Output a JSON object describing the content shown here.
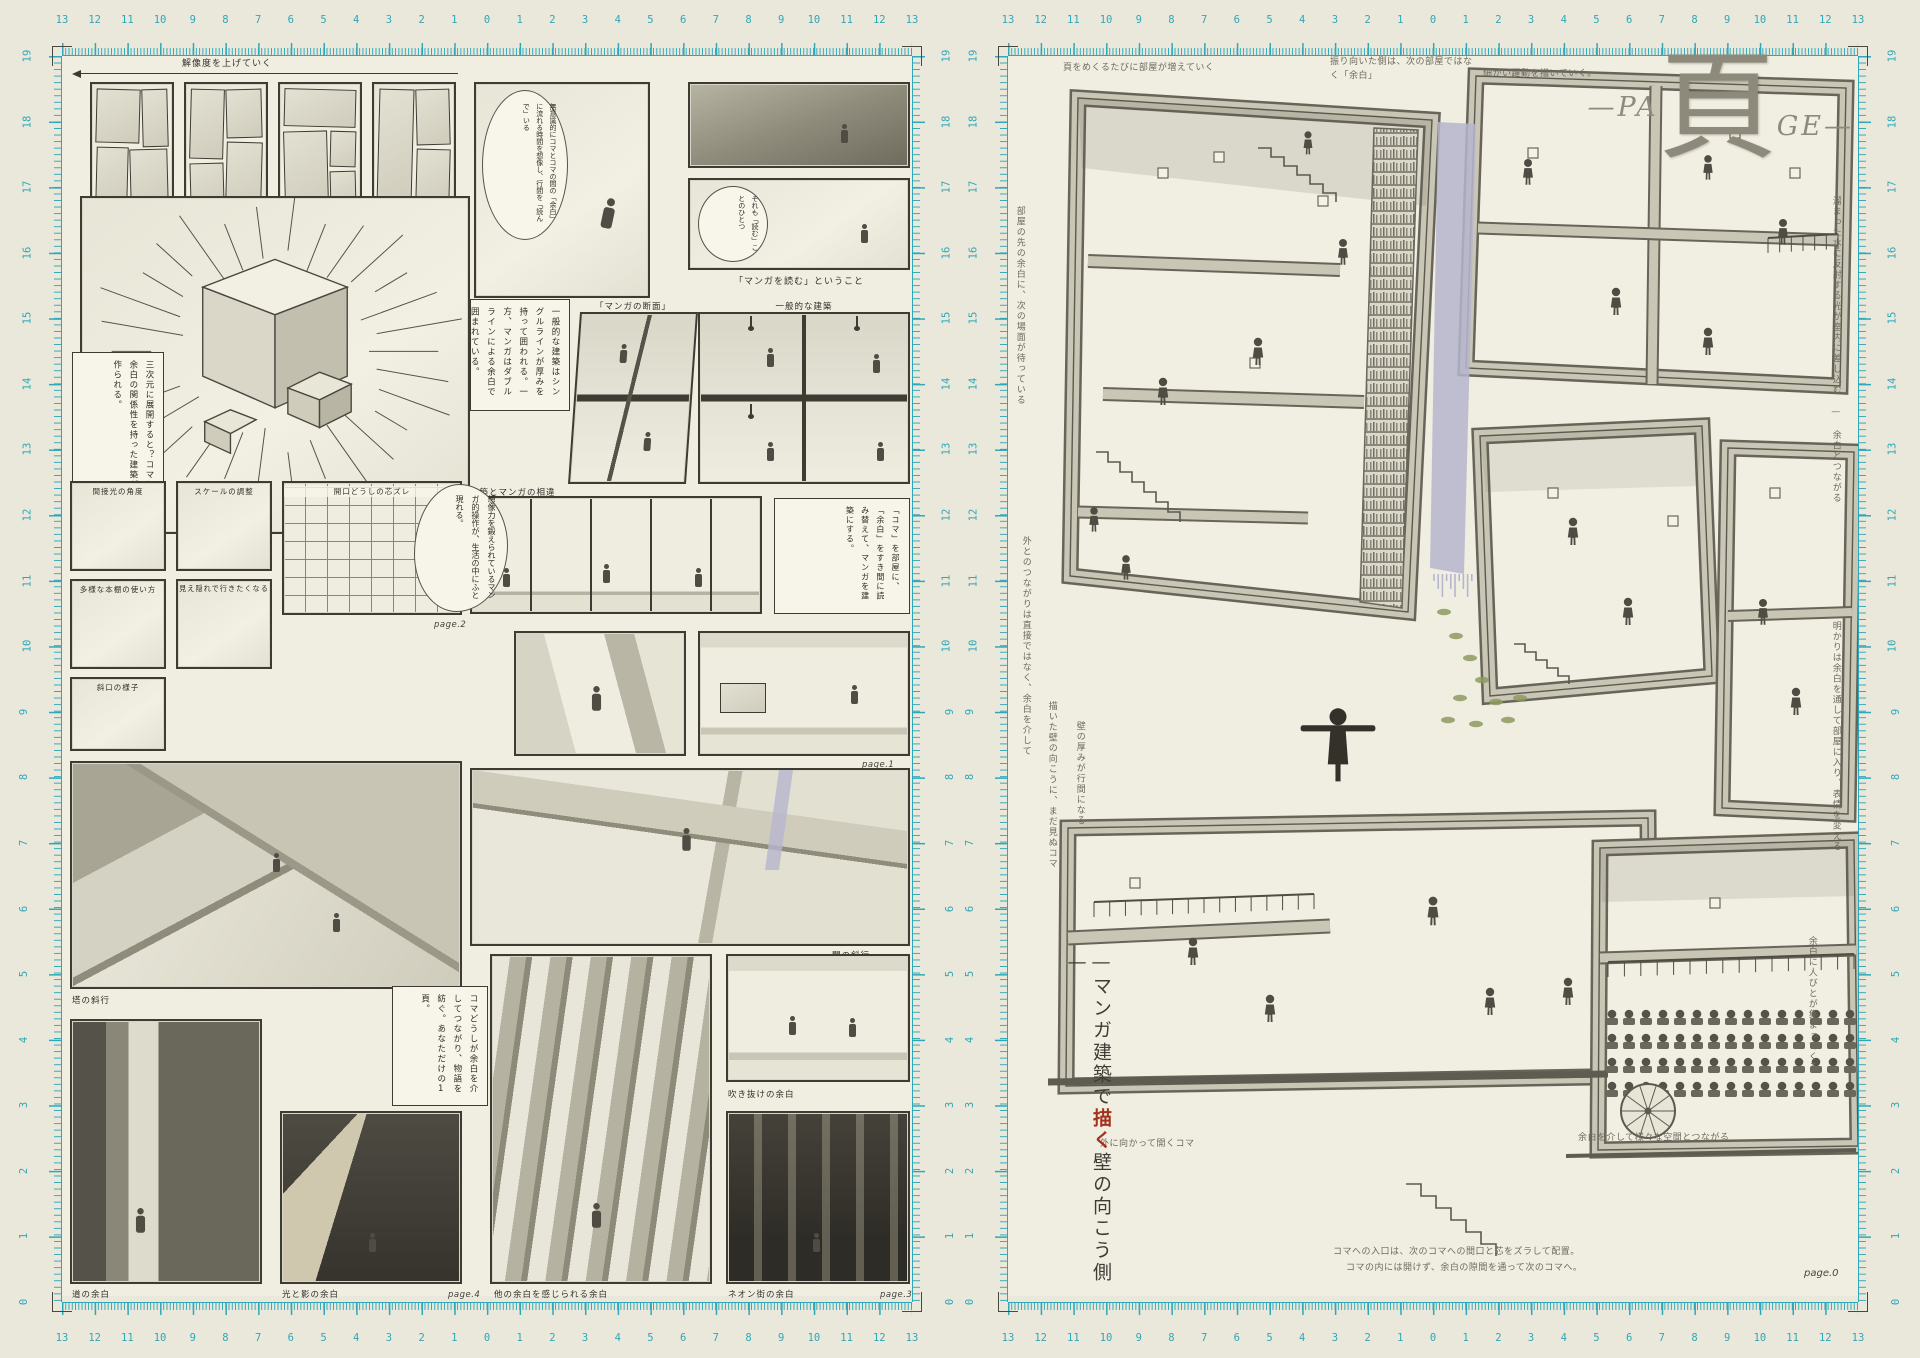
{
  "colors": {
    "ruler": "#2fa7ba",
    "accent_red": "#a3321f",
    "lavender": "#b6b5ce",
    "moss": "#8e9a60",
    "concrete": "#c9c6b6",
    "title_gray": "#8d8a7b",
    "paper": "#eae8da"
  },
  "rulers": {
    "h_numbers": [
      13,
      12,
      11,
      10,
      9,
      8,
      7,
      6,
      5,
      4,
      3,
      2,
      1,
      0,
      1,
      2,
      3,
      4,
      5,
      6,
      7,
      8,
      9,
      10,
      11,
      12,
      13
    ],
    "v_numbers": [
      19,
      18,
      17,
      16,
      15,
      14,
      13,
      12,
      11,
      10,
      9,
      8,
      7,
      6,
      5,
      4,
      3,
      2,
      1,
      0
    ]
  },
  "left_page": {
    "resolution_caption": "解像度を上げていく",
    "reader_label": "読み手側",
    "reading_bubble": "無意識的にコマとコマの間の「余白」に流れる時間を想像し、行間を「読んで」いる",
    "sore_bubble": "それも「読む」ことのひとつ",
    "reading_caption": "「マンガを読む」ということ",
    "cube_box": "三次元に展開すると？コマと余白の関係性を持った建築が作られる。",
    "model_caption": "完成模型",
    "line_box": "一般的な建築はシングルラインが厚みを持って囲われる。一方、マンガはダブルラインによる余白で囲まれている。",
    "section_caption": "「マンガの断面」",
    "general_caption": "一般的な建築",
    "diff_caption": "建築とマンガの相違",
    "digest_box": "「コマ」を部屋に、「余白」をすき間に読み替えて、マンガを建築にする。",
    "thought_bubble": "想像力を鍛えられているマンガ的操作が、生活の中にふと現れる。",
    "ops": {
      "r1c1": "間接光の角度",
      "r1c2": "スケールの調整",
      "r1c3": "開口どうしの芯ズレ",
      "r2c1": "多様な本棚の使い方",
      "r2c2": "見え隠れで行きたくなる",
      "r3c1": "斜口の様子"
    },
    "slant_caption_tower": "塔の斜行",
    "slant_caption_ma": "間の斜行",
    "margin_caption_road": "道の余白",
    "margin_caption_light": "光と影の余白",
    "margin_caption_others": "他の余白を感じられる余白",
    "margin_caption_void": "吹き抜けの余白",
    "margin_caption_neon": "ネオン街の余白",
    "connect_box": "コマどうしが余白を介してつながり、物語を紡ぐ。あなただけの1頁。",
    "page1": "page.1",
    "page2": "page.2",
    "page3": "page.3",
    "page4": "page.4"
  },
  "right_page": {
    "title": {
      "lead_dash": "—",
      "pa": "PA",
      "kanji": "頁",
      "ge": "GE",
      "tail_dash": "—"
    },
    "vertical_title": {
      "pre": "—マンガ建築で",
      "red": "描く",
      "post": "壁の向こう側—"
    },
    "page_label": "page.0",
    "notes": [
      {
        "id": "n0",
        "text": "頁をめくるたびに部屋が増えていく"
      },
      {
        "id": "n1",
        "text": "振り向いた側は、次の部屋ではなく「余白」"
      },
      {
        "id": "n2",
        "text": "細かい躍動を描いていく。"
      },
      {
        "id": "n3",
        "text": "部屋の先の余白に、次の場面が待っている"
      },
      {
        "id": "n4",
        "text": "外とのつながりは直接ではなく、余白を介して"
      },
      {
        "id": "n5",
        "text": "描いた壁の向こうに、まだ見ぬコマ"
      },
      {
        "id": "n6",
        "text": "壁の厚みが行間になる"
      },
      {
        "id": "r1",
        "text": "溜まった水に反射する光が室内に差し込む — 余白とつながる"
      },
      {
        "id": "r2",
        "text": "明かりは余白を通して部屋に入り、表情を変える"
      },
      {
        "id": "r3",
        "text": "余白に人びとが集まってくる"
      },
      {
        "id": "b1",
        "text": "外に向かって開くコマ"
      },
      {
        "id": "b2",
        "text": "余白を介して様々な空間とつながる"
      },
      {
        "id": "b3a",
        "text": "コマへの入口は、次のコマへの間口と芯をズラして配置。"
      },
      {
        "id": "b3b",
        "text": "コマの内には開けず、余白の隙間を通って次のコマへ。"
      }
    ]
  }
}
